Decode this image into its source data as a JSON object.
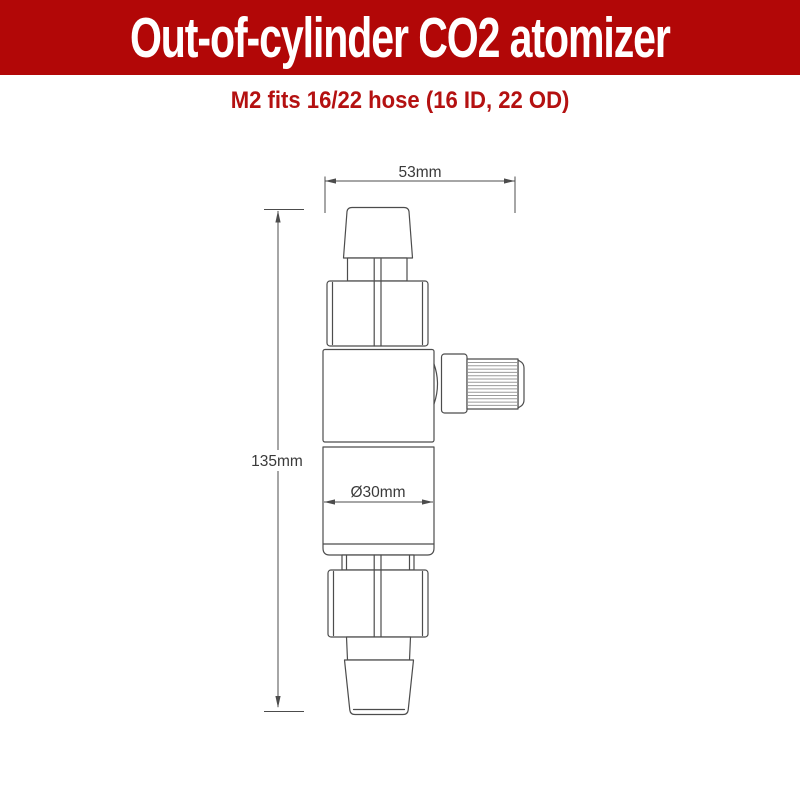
{
  "header": {
    "title": "Out-of-cylinder CO2 atomizer",
    "background_color": "#b20707",
    "text_color": "#ffffff"
  },
  "subtitle": {
    "text": "M2 fits 16/22 hose (16 ID, 22 OD)",
    "color": "#b41111"
  },
  "diagram": {
    "line_color": "#4c4c4c",
    "dimension_labels": {
      "width": "53mm",
      "height": "135mm",
      "diameter": "Ø30mm"
    }
  }
}
